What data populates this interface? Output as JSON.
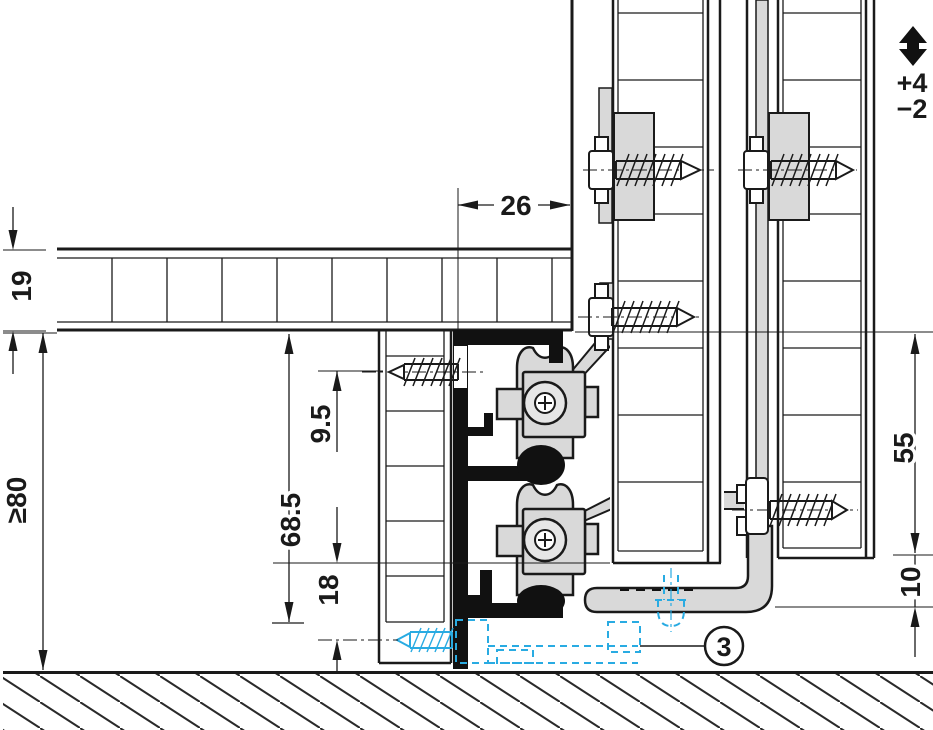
{
  "drawing": {
    "kind": "sliding-door-fitting cross-section",
    "dimensions": {
      "shelf_thickness": "19",
      "clearance_min": "≥80",
      "screw_axis_offset": "9.5",
      "profile_drop": "68.5",
      "floor_guide_offset": "18",
      "front_overhang": "26",
      "door_drop": "55",
      "guide_clearance": "10"
    },
    "height_adjustment": {
      "icon": "vertical-adjust-arrow-icon",
      "plus": "+4",
      "minus": "−2"
    },
    "callout_3": "3",
    "colors": {
      "line": "#1a1a1a",
      "hardware_fill": "#d9d9d9",
      "highlight_cyan": "#29abe2",
      "background": "#ffffff"
    }
  }
}
